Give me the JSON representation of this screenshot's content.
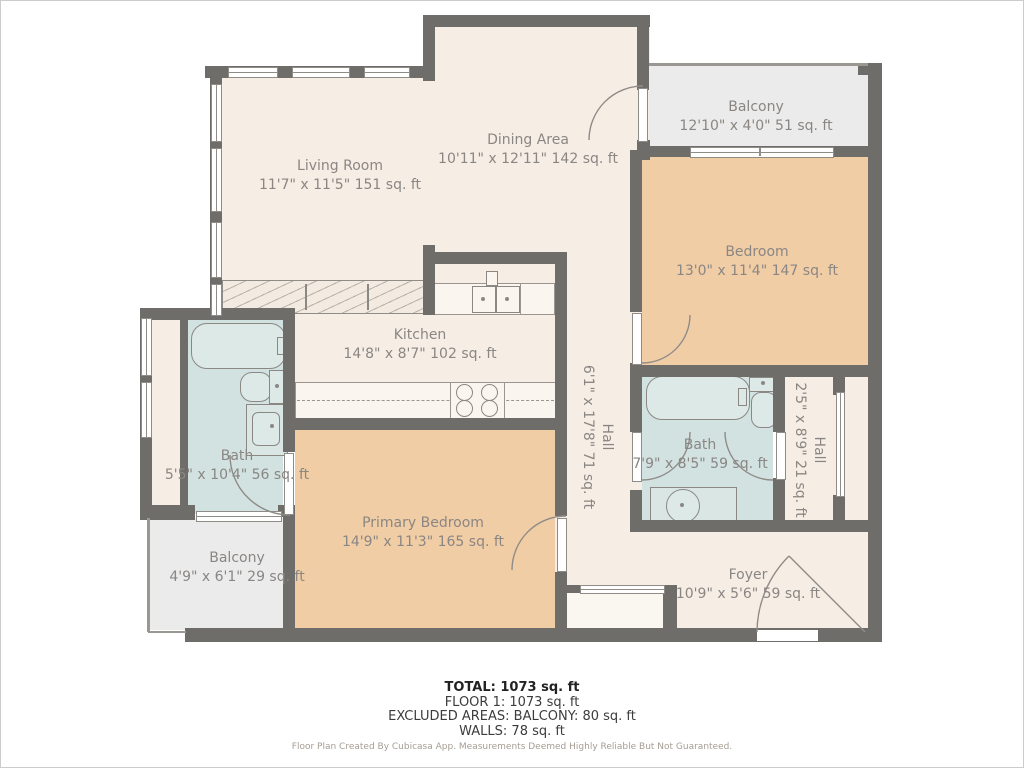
{
  "rooms": {
    "living_room": {
      "name": "Living Room",
      "dims": "11'7\" x 11'5\" 151 sq. ft"
    },
    "dining_area": {
      "name": "Dining Area",
      "dims": "10'11\" x 12'11\" 142 sq. ft"
    },
    "balcony_top": {
      "name": "Balcony",
      "dims": "12'10\" x 4'0\" 51 sq. ft"
    },
    "bedroom": {
      "name": "Bedroom",
      "dims": "13'0\" x 11'4\" 147 sq. ft"
    },
    "kitchen": {
      "name": "Kitchen",
      "dims": "14'8\" x 8'7\" 102 sq. ft"
    },
    "bath_left": {
      "name": "Bath",
      "dims": "5'5\" x 10'4\" 56 sq. ft"
    },
    "hall_center": {
      "name": "Hall",
      "dims": "6'1\" x 17'8\" 71 sq. ft"
    },
    "bath_right": {
      "name": "Bath",
      "dims": "7'9\" x 8'5\" 59 sq. ft"
    },
    "hall_right": {
      "name": "Hall",
      "dims": "2'5\" x 8'9\" 21 sq. ft"
    },
    "primary_bedroom": {
      "name": "Primary Bedroom",
      "dims": "14'9\" x 11'3\" 165 sq. ft"
    },
    "balcony_bottom": {
      "name": "Balcony",
      "dims": "4'9\" x 6'1\" 29 sq. ft"
    },
    "foyer": {
      "name": "Foyer",
      "dims": "10'9\" x 5'6\" 59 sq. ft"
    }
  },
  "summary": {
    "total": "TOTAL: 1073 sq. ft",
    "floor": "FLOOR 1: 1073 sq. ft",
    "excluded": "EXCLUDED AREAS: BALCONY: 80 sq. ft",
    "walls": "WALLS: 78 sq. ft"
  },
  "footer": {
    "credit": "Floor Plan Created By Cubicasa App. Measurements Deemed Highly Reliable But Not Guaranteed."
  },
  "colors": {
    "wall": "#6f6d6a",
    "floor_cream": "#f6eee5",
    "bedroom_tan": "#f1cda6",
    "bath_blue": "#d2e2e0",
    "balcony_gray": "#ebebeb",
    "outline_gray": "#8f8c88",
    "label_text": "#8a8683",
    "summary_text": "#3c3c3c",
    "credit_text": "#a59d93"
  }
}
